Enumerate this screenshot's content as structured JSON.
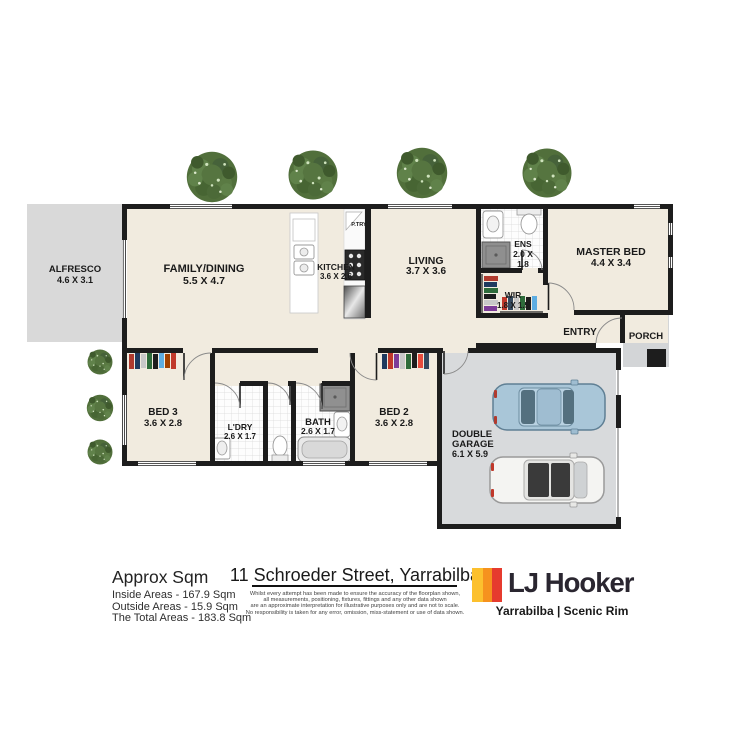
{
  "plan": {
    "rooms": {
      "alfresco": {
        "name": "ALFRESCO",
        "dims": "4.6 X 3.1"
      },
      "family": {
        "name": "FAMILY/DINING",
        "dims": "5.5 X 4.7"
      },
      "kitchen": {
        "name": "KITCHEN",
        "dims": "3.6 X 2.6"
      },
      "pantry": {
        "name": "P.TRY"
      },
      "living": {
        "name": "LIVING",
        "dims": "3.7 X 3.6"
      },
      "ens": {
        "name": "ENS",
        "dims_line1": "2.0 X",
        "dims_line2": "1.8"
      },
      "master": {
        "name": "MASTER BED",
        "dims": "4.4 X 3.4"
      },
      "wir": {
        "name": "WIR",
        "dims": "1.8 X 1.5"
      },
      "entry": {
        "name": "ENTRY"
      },
      "porch": {
        "name": "PORCH"
      },
      "bed3": {
        "name": "BED 3",
        "dims": "3.6 X 2.8"
      },
      "laundry": {
        "name": "L'DRY",
        "dims": "2.6 X 1.7"
      },
      "bath": {
        "name": "BATH",
        "dims": "2.6 X 1.7"
      },
      "bed2": {
        "name": "BED 2",
        "dims": "3.6 X 2.8"
      },
      "garage": {
        "name_line1": "DOUBLE",
        "name_line2": "GARAGE",
        "dims": "6.1 X 5.9"
      }
    },
    "colors": {
      "floor": "#f1ebdf",
      "outdoor": "#d9d9d9",
      "garage_floor": "#d8dadc",
      "wall": "#1d1d1d"
    }
  },
  "footer": {
    "approx": {
      "heading": "Approx Sqm",
      "inside": "Inside Areas - 167.9 Sqm",
      "outside": "Outside Areas - 15.9 Sqm",
      "total": "The Total Areas - 183.8 Sqm"
    },
    "address": "11 Schroeder Street, Yarrabilba",
    "disclaimer": [
      "Whilst every attempt has been made to ensure the accuracy of the floorplan shown,",
      "all measurements, positioning, fixtures, fittings and any other data shown",
      "are an approximate interpretation for illustrative purposes only and are not to scale.",
      "No responsibility is taken for any error, omission, miss-statement or use of data shown."
    ],
    "brand": {
      "name": "LJ Hooker",
      "office": "Yarrabilba | Scenic Rim",
      "stripe_colors": {
        "yellow": "#FCC02E",
        "orange": "#F6921E",
        "red": "#E63B2E"
      }
    }
  }
}
